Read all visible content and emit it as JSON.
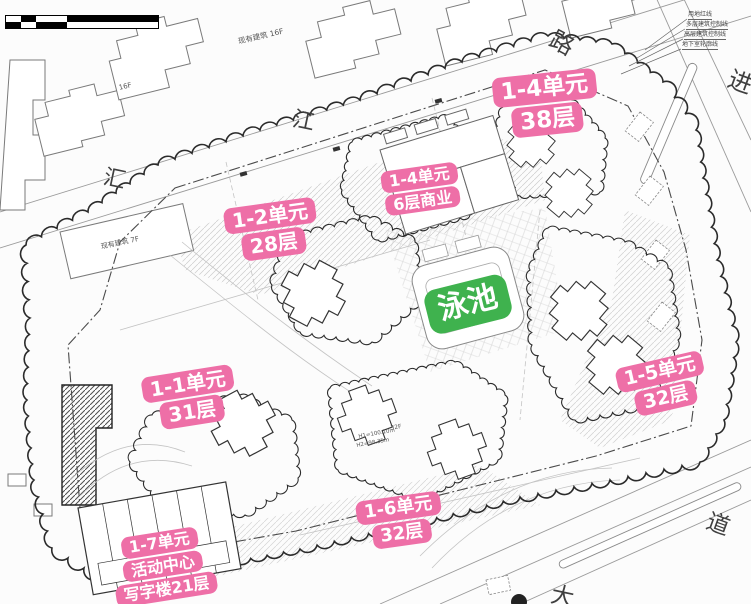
{
  "colors": {
    "annotation_pink": "#ee6fa7",
    "pool_green": "#3fb24e",
    "line_dark": "#333333",
    "line_light": "#9b9b9b"
  },
  "scale_bar": {
    "top_ticks": [
      "0",
      "10"
    ],
    "bottom_ticks": [
      "5",
      "20m",
      "50m"
    ]
  },
  "streets": {
    "hui": "汇",
    "jiang": "江",
    "lu": "路",
    "jin": "进",
    "dao": "道",
    "da": "大"
  },
  "unit_labels": [
    {
      "id": "1-1",
      "lines": [
        "1-1单元",
        "31层"
      ]
    },
    {
      "id": "1-2",
      "lines": [
        "1-2单元",
        "28层"
      ]
    },
    {
      "id": "1-4-tower",
      "lines": [
        "1-4单元",
        "38层"
      ]
    },
    {
      "id": "1-4-podium",
      "lines": [
        "1-4单元",
        "6层商业"
      ]
    },
    {
      "id": "1-5",
      "lines": [
        "1-5单元",
        "32层"
      ]
    },
    {
      "id": "1-6",
      "lines": [
        "1-6单元",
        "32层"
      ]
    },
    {
      "id": "1-7",
      "lines": [
        "1-7单元",
        "活动中心",
        "写字楼21层"
      ]
    }
  ],
  "pool": {
    "label": "泳池"
  },
  "existing": {
    "b16f": "现有建筑 16F",
    "f16": "16F",
    "b7f": "现有建筑 7F"
  },
  "legend_callouts": [
    "用地红线",
    "多层建筑控制线",
    "高层建筑控制线",
    "地下室轮廓线"
  ],
  "micro": [
    "32F",
    "H1=100.10m",
    "H2=98.35m"
  ]
}
